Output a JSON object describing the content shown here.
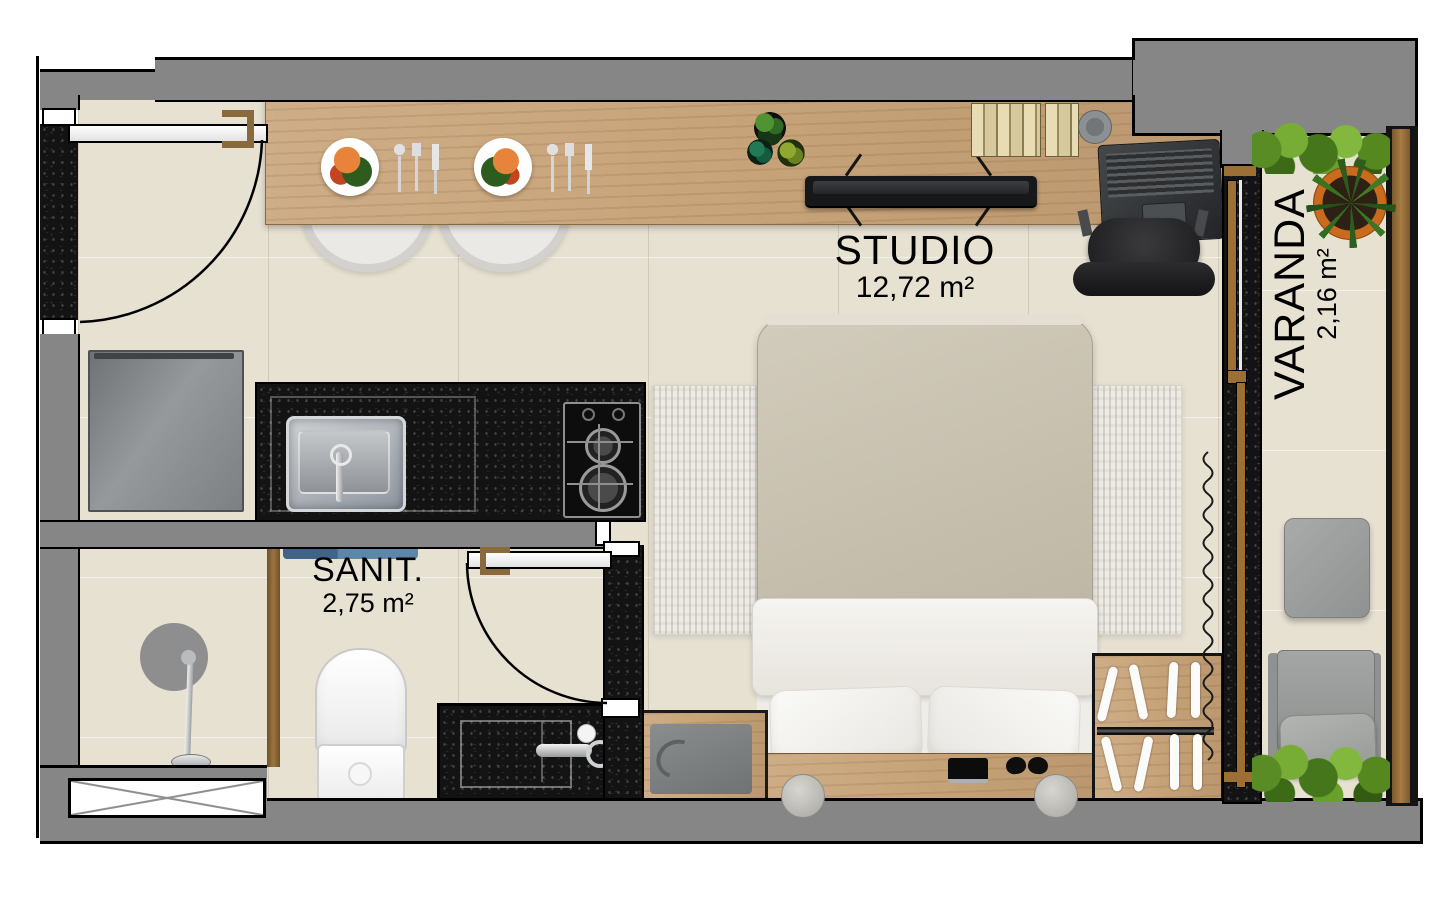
{
  "rooms": {
    "studio": {
      "name": "STUDIO",
      "area": "12,72 m²"
    },
    "sanit": {
      "name": "SANIT.",
      "area": "2,75 m²"
    },
    "varanda": {
      "name": "VARANDA",
      "area": "2,16 m²"
    }
  },
  "palette": {
    "wall_gray": "#868686",
    "granite_black": "#131313",
    "wood_light": "#c8a47a",
    "floor_beige": "#e7e1d2",
    "hedge_green": "#6ca52f",
    "frame_brown": "#9c6f35",
    "mat_blue": "#5e86a6"
  },
  "furniture_icons": [
    "entrance-door-icon",
    "dining-counter-icon",
    "dinner-plate-icon",
    "cutlery-icon",
    "dining-chair-icon",
    "tv-icon",
    "books-icon",
    "plant-pot-icon",
    "cup-icon",
    "laptop-icon",
    "desk-chair-icon",
    "fridge-icon",
    "kitchen-sink-icon",
    "cooktop-icon",
    "bed-icon",
    "pillow-icon",
    "rug-icon",
    "nightstand-icon",
    "tshirt-icon",
    "wardrobe-icon",
    "hanger-icon",
    "curtain-icon",
    "phone-icon",
    "slippers-icon",
    "toilet-icon",
    "bathroom-sink-icon",
    "shower-icon",
    "bath-mat-icon",
    "window-vent-icon",
    "sliding-door-icon",
    "balcony-armchair-icon",
    "balcony-cushion-icon",
    "aloe-plant-icon",
    "hedge-icon"
  ]
}
